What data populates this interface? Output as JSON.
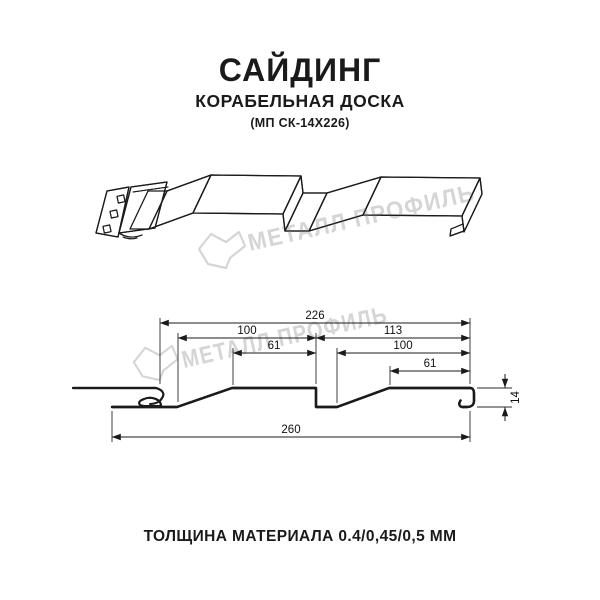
{
  "page": {
    "background": "#ffffff",
    "line_color": "#1b1b1b"
  },
  "header": {
    "title": "САЙДИНГ",
    "subtitle": "КОРАБЕЛЬНАЯ ДОСКА",
    "model_code": "(МП СК-14Х226)"
  },
  "watermark": {
    "brand": "МЕТАЛЛ ПРОФИЛЬ",
    "color": "#d5d5d5"
  },
  "diagram": {
    "views": {
      "top": "3d profile view of siding panel",
      "bottom": "cross-section with dimensions"
    },
    "dimensions": {
      "top_width": "226",
      "left_board_width": "100",
      "right_board_width": "113",
      "left_flat": "61",
      "right_flat": "100",
      "right_end_flat": "61",
      "overall_width": "260",
      "profile_height": "14"
    }
  },
  "footer": {
    "thickness": "ТОЛЩИНА МАТЕРИАЛА 0.4/0,45/0,5 ММ"
  }
}
